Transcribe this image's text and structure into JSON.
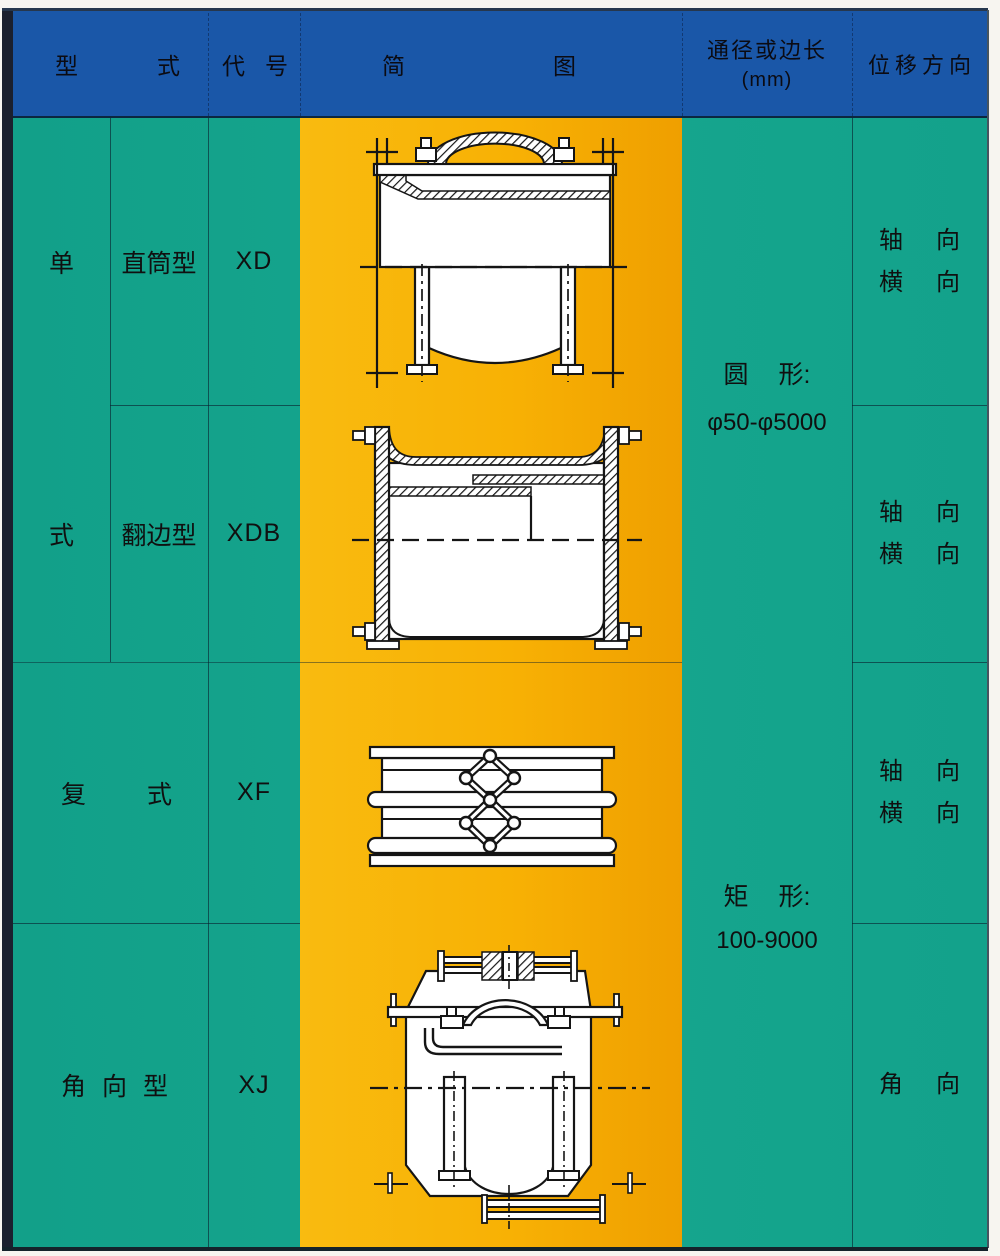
{
  "colors": {
    "header_bg": "#1a57a8",
    "body_bg": "#14a38c",
    "diagram_bg": "#f8b104",
    "frame_dark": "#1b202e",
    "text": "#101010"
  },
  "header": {
    "type": [
      "型",
      "式"
    ],
    "code": [
      "代",
      "号"
    ],
    "diagram": [
      "简",
      "图"
    ],
    "size_line1": "通径或边长",
    "size_line2": "(mm)",
    "displacement": "位移方向"
  },
  "type_column": {
    "group_char_top": "单",
    "group_char_bottom": "式",
    "row1": "直筒型",
    "row2": "翻边型",
    "row3": [
      "复",
      "式"
    ],
    "row4": [
      "角",
      "向",
      "型"
    ]
  },
  "code_column": {
    "row1": "XD",
    "row2": "XDB",
    "row3": "XF",
    "row4": "XJ"
  },
  "size_column": {
    "round_label": [
      "圆",
      "形:"
    ],
    "round_range": "φ50-φ5000",
    "rect_label": [
      "矩",
      "形:"
    ],
    "rect_range": "100-9000"
  },
  "displacement_column": {
    "row1": [
      [
        "轴",
        "向"
      ],
      [
        "横",
        "向"
      ]
    ],
    "row2": [
      [
        "轴",
        "向"
      ],
      [
        "横",
        "向"
      ]
    ],
    "row3": [
      [
        "轴",
        "向"
      ],
      [
        "横",
        "向"
      ]
    ],
    "row4": [
      [
        "角",
        "向"
      ]
    ]
  },
  "diagrams": {
    "row1": "xd-straight-tube-joint-diagram",
    "row2": "xdb-flanged-joint-diagram",
    "row3": "xf-double-bellows-joint-diagram",
    "row4": "xj-angular-joint-diagram"
  }
}
